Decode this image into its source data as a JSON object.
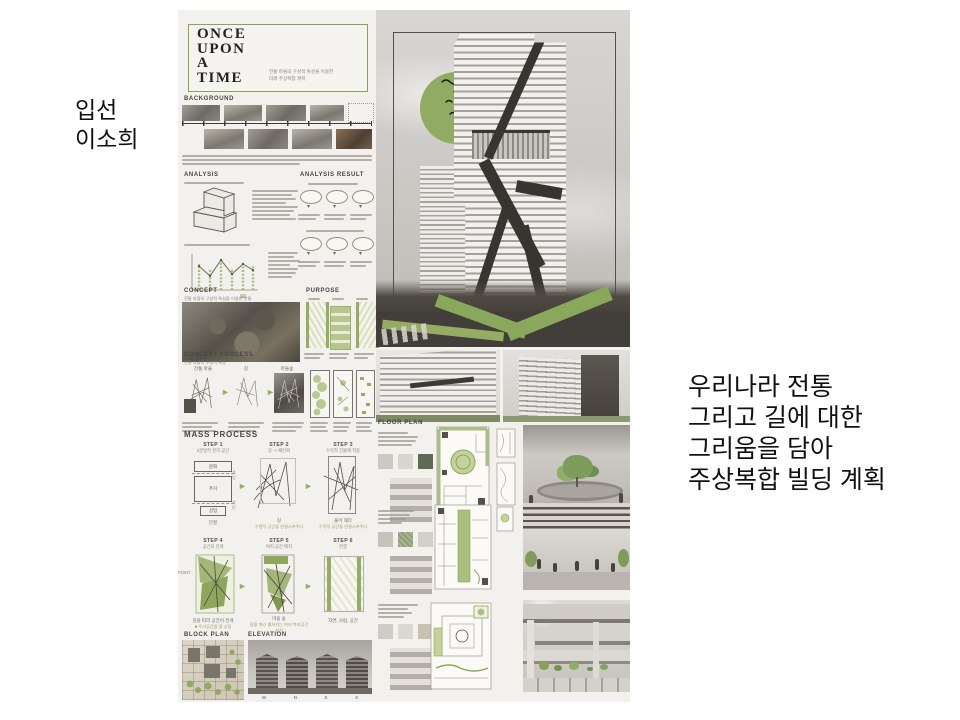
{
  "left_caption": {
    "lines": [
      "입선",
      "이소희"
    ]
  },
  "right_caption": {
    "lines": [
      "우리나라 전통",
      "그리고 길에 대한",
      "그리움을 담아",
      "주상복합 빌딩 계획"
    ]
  },
  "poster": {
    "title": {
      "lines": [
        "ONCE",
        "UPON",
        "A",
        "TIME"
      ],
      "subtitle_lines": [
        "전통 마을의 구성적 특성을 이용한",
        "미래 주상복합 계획"
      ]
    },
    "sections": {
      "background": "BACKGROUND",
      "analysis": "ANALYSIS",
      "analysis_result": "ANALYSIS RESULT",
      "concept": "CONCEPT",
      "purpose": "PURPOSE",
      "concept_process": "CONCEPT PROCESS",
      "mass_process": "MASS PROCESS",
      "block_plan": "BLOCK PLAN",
      "elevation": "ELEVATION",
      "floor_plan": "FLOOR PLAN"
    },
    "concept_subtitle": "전통 마을의 구성적 특성을 이용한 전통",
    "concept_process_subtitle": "전통 마을의 구성적 특징",
    "concept_process_labels": [
      "전통 마을",
      "길",
      "마을숲"
    ],
    "mass_steps": [
      {
        "step": "STEP 1",
        "title": "2분법적 분리 공간",
        "caption": "단절"
      },
      {
        "step": "STEP 2",
        "title": "길 -> 패턴화",
        "caption": "길",
        "sub": "수평적 공간을 연결시켜주다"
      },
      {
        "step": "STEP 3",
        "title": "수직적 건물에 적용",
        "caption": "풀어 헤다",
        "sub": "수직적 공간을 연결시켜주다"
      },
      {
        "step": "STEP 4",
        "title": "공간의 전개",
        "caption": "길을 따라 공간이 전개",
        "sub": "■ 주거공간을 몰 상점"
      },
      {
        "step": "STEP 5",
        "title": "여러 공간 배치",
        "caption": "마을 숲",
        "sub": "길을 따라 펼쳐지는 여러 복지공간 설치"
      },
      {
        "step": "STEP 6",
        "title": "연결",
        "caption": "자연, 사람, 공간"
      }
    ],
    "step1_labels": {
      "top": "문화",
      "mid": "주거",
      "bottom": "상업",
      "cut": "차단"
    },
    "step4_point": "POINT",
    "elevation_letters": [
      "W",
      "N",
      "E",
      "S"
    ]
  },
  "colors": {
    "accent_green": "#94ad62",
    "border_green": "#8ba34f",
    "dark_ink": "#3c3835",
    "poster_bg": "#f3f1ed",
    "page_bg": "#ffffff"
  }
}
